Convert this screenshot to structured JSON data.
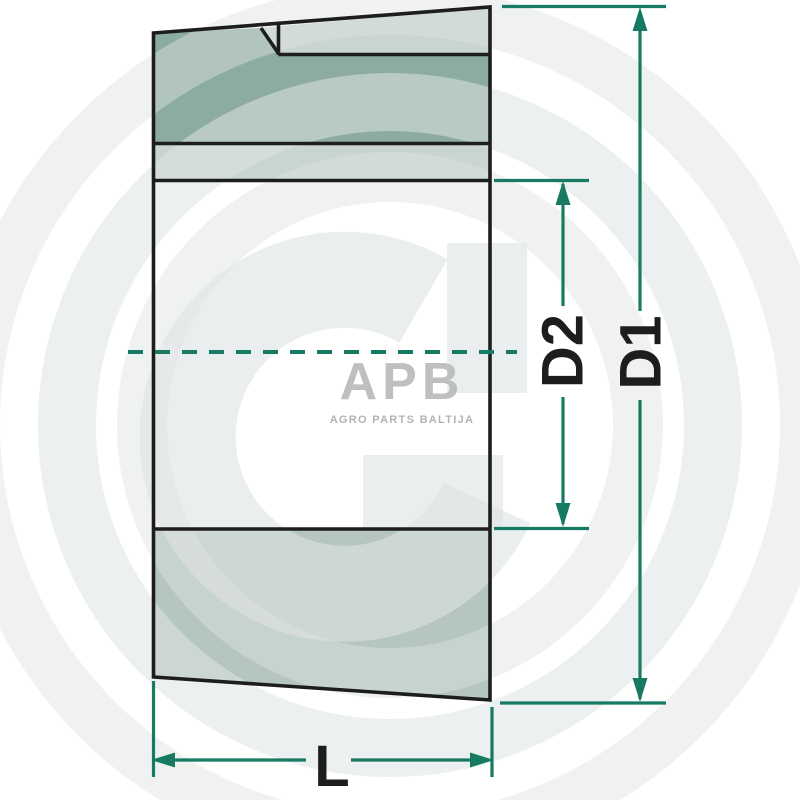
{
  "watermark_logo": {
    "brand": "APB",
    "tagline": "AGRO PARTS BALTIJA"
  },
  "dimension_labels": {
    "outer_diameter": "D1",
    "inner_diameter": "D2",
    "length": "L"
  },
  "colors": {
    "dimension_accent": "#177a62",
    "outline_black": "#1d1d1d",
    "fill_dark_sage": "#8daca0",
    "fill_light_sage": "#c8d5d0",
    "fill_medium_sage": "#b5c6c0",
    "watermark_gray": "#eeeeee",
    "logo_gray": "#bfbfbf"
  }
}
